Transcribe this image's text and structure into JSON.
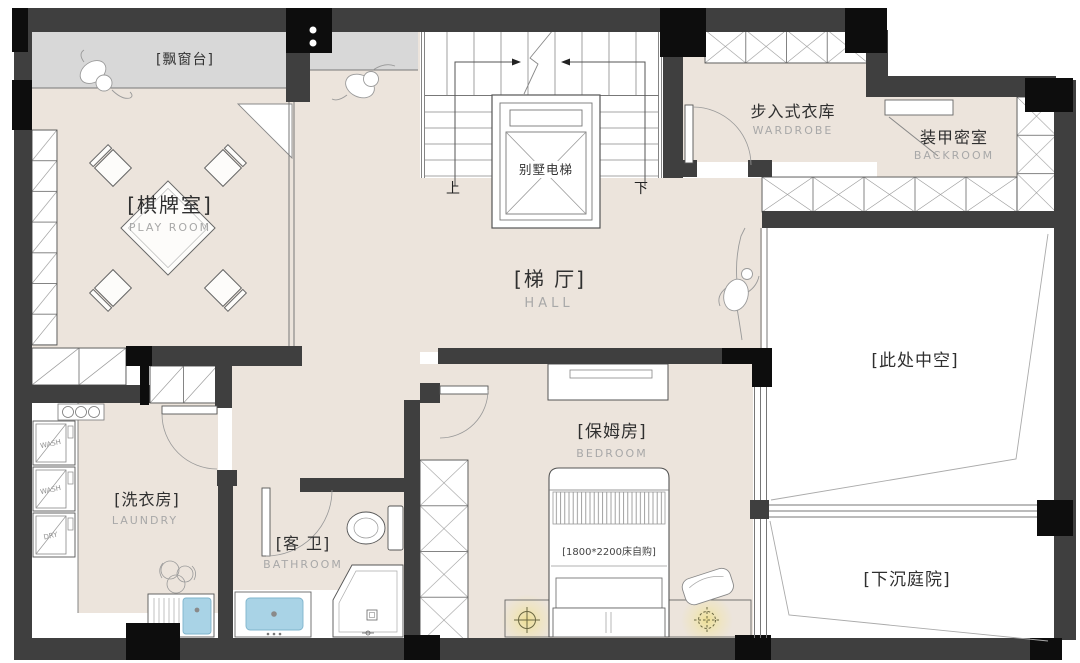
{
  "plan": {
    "title": "residential basement floor plan",
    "rooms": {
      "bay_window": {
        "label": "[飘窗台]"
      },
      "play_room": {
        "label": "[棋牌室]",
        "sublabel": "PLAY ROOM"
      },
      "hall": {
        "label": "[梯 厅]",
        "sublabel": "HALL"
      },
      "wardrobe": {
        "label": "步入式衣库",
        "sublabel": "WARDROBE"
      },
      "backroom": {
        "label": "装甲密室",
        "sublabel": "BACKROOM"
      },
      "void": {
        "label": "[此处中空]"
      },
      "bedroom": {
        "label": "[保姆房]",
        "sublabel": "BEDROOM",
        "bed_note": "[1800*2200床自购]"
      },
      "laundry": {
        "label": "[洗衣房]",
        "sublabel": "LAUNDRY"
      },
      "bathroom": {
        "label": "[客 卫]",
        "sublabel": "BATHROOM"
      },
      "courtyard": {
        "label": "[下沉庭院]"
      }
    },
    "stairs": {
      "elevator_label": "别墅电梯",
      "up_label": "上",
      "down_label": "下"
    },
    "appliances": {
      "washer1": "WASH",
      "washer2": "WASH",
      "dryer": "DRY"
    },
    "colors": {
      "wall": "#3f3f3f",
      "column": "#0d0d0d",
      "floor_beige": "#ece4dc",
      "bay_gray": "#d8d8d8",
      "sink_blue": "#a9d3e6",
      "lamp_glow": "#eedf8e"
    }
  }
}
